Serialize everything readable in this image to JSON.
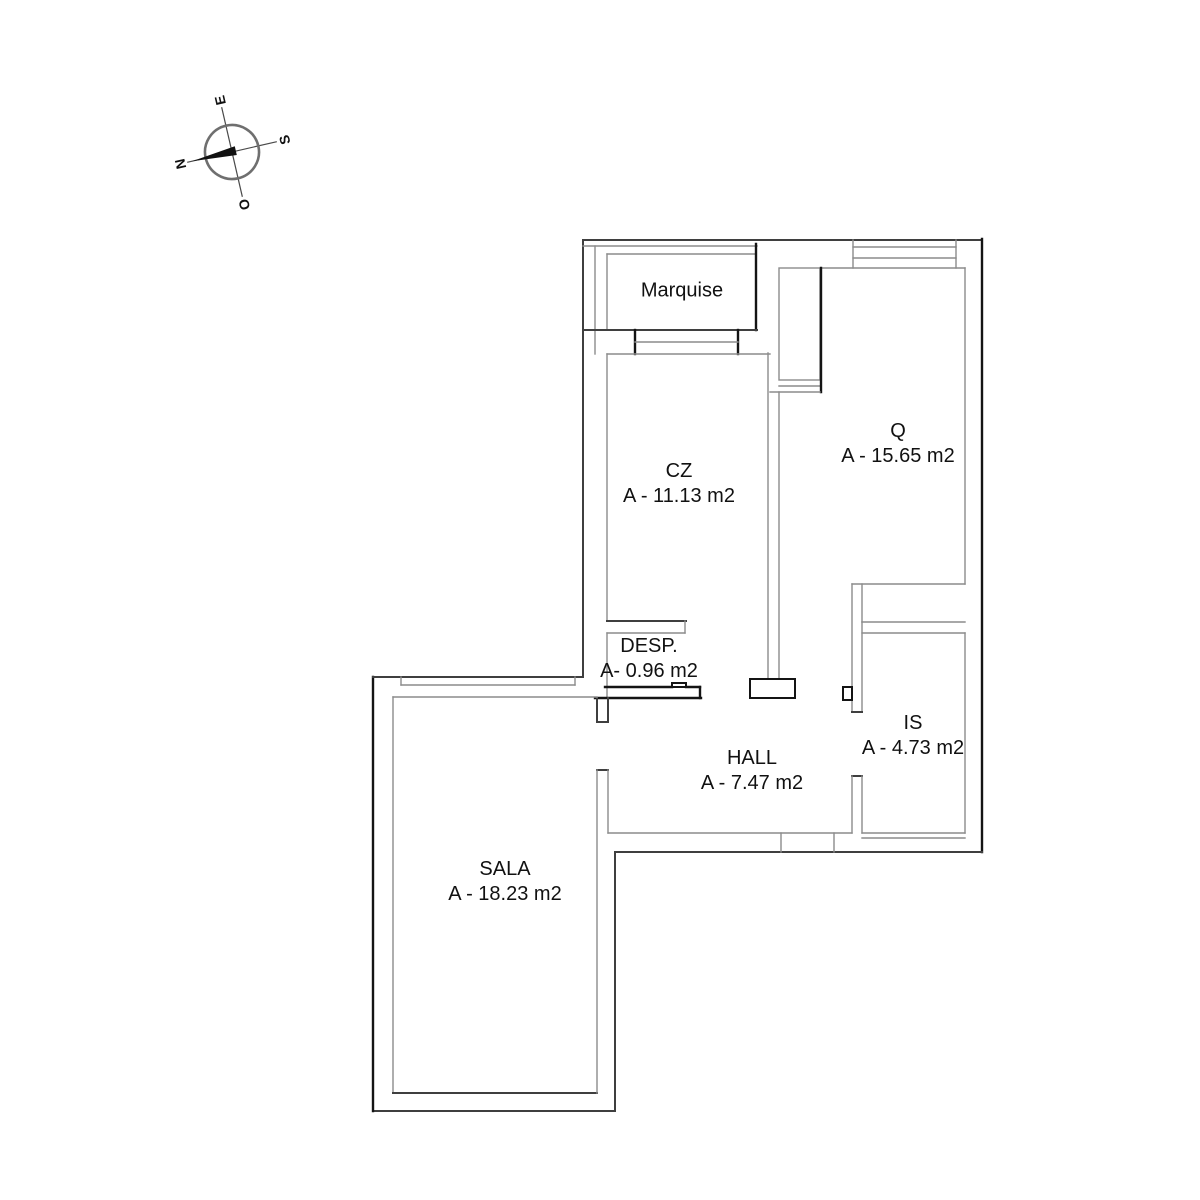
{
  "document": {
    "type": "architectural floor plan",
    "background": "#ffffff"
  },
  "compass": {
    "north": "N",
    "east": "E",
    "south": "S",
    "west": "O"
  },
  "rooms": [
    {
      "name": "Marquise",
      "area": ""
    },
    {
      "name": "CZ",
      "area": "A - 11.13 m2"
    },
    {
      "name": "Q",
      "area": "A - 15.65 m2"
    },
    {
      "name": "DESP.",
      "area": "A- 0.96 m2"
    },
    {
      "name": "IS",
      "area": "A - 4.73 m2"
    },
    {
      "name": "HALL",
      "area": "A - 7.47 m2"
    },
    {
      "name": "SALA",
      "area": "A - 18.23 m2"
    }
  ],
  "colors": {
    "wall_light": "#8c8c8c",
    "wall_medium": "#3f3f3f",
    "wall_dark": "#141414",
    "text": "#111111",
    "background": "#ffffff"
  }
}
